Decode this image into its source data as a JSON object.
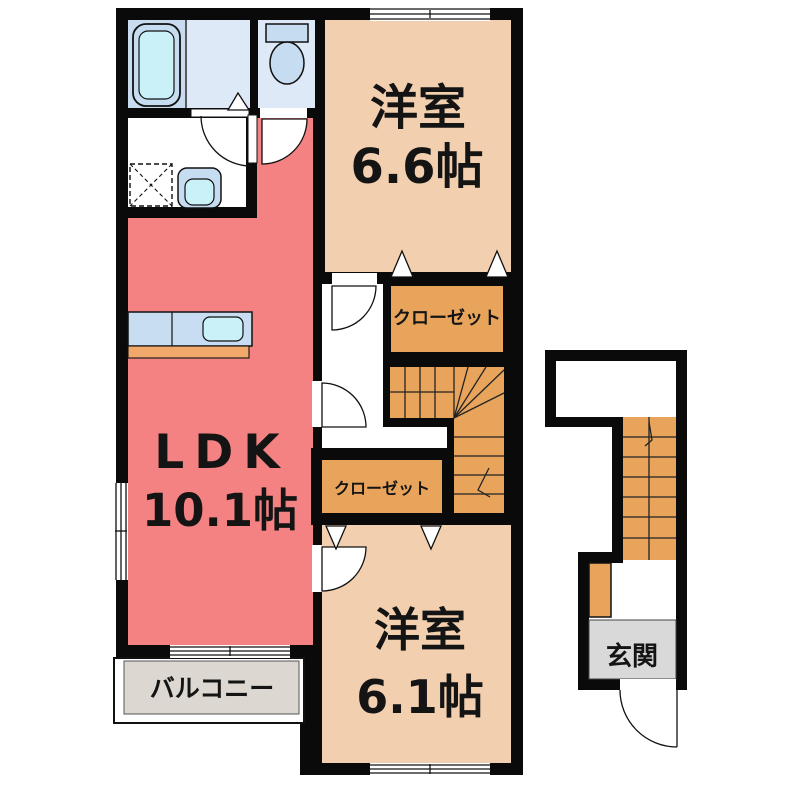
{
  "plan": {
    "type": "apartment-floor-plan",
    "rooms": {
      "western_room_upper": {
        "name": "洋室",
        "size": "6.6帖"
      },
      "ldk": {
        "name": "LDK",
        "size": "10.1帖"
      },
      "western_room_lower": {
        "name": "洋室",
        "size": "6.1帖"
      },
      "closet_upper": {
        "label": "クローゼット"
      },
      "closet_lower": {
        "label": "クローゼット"
      },
      "balcony": {
        "label": "バルコニー"
      },
      "entrance": {
        "label": "玄関"
      }
    },
    "fixtures": [
      "bathtub",
      "toilet",
      "washing-machine",
      "vanity-sink",
      "kitchen-counter",
      "stairs-main",
      "stairs-entrance"
    ],
    "colors": {
      "wall": "#0a0a0a",
      "ldk_floor": "#f58282",
      "room_floor": "#f2cfae",
      "closet_floor": "#e9a45c",
      "stairs_floor": "#e9a45c",
      "balcony_floor": "#dcd8d1",
      "entrance_floor": "#d9d9d9",
      "bath_floor": "#dde9f6",
      "bath_panel": "#c9dbee",
      "fixture_blue": "#c6dcf0",
      "fixture_cyan": "#c9f1f7",
      "counter_blue": "#c8ddf2",
      "counter_orange": "#f0a96a"
    }
  }
}
